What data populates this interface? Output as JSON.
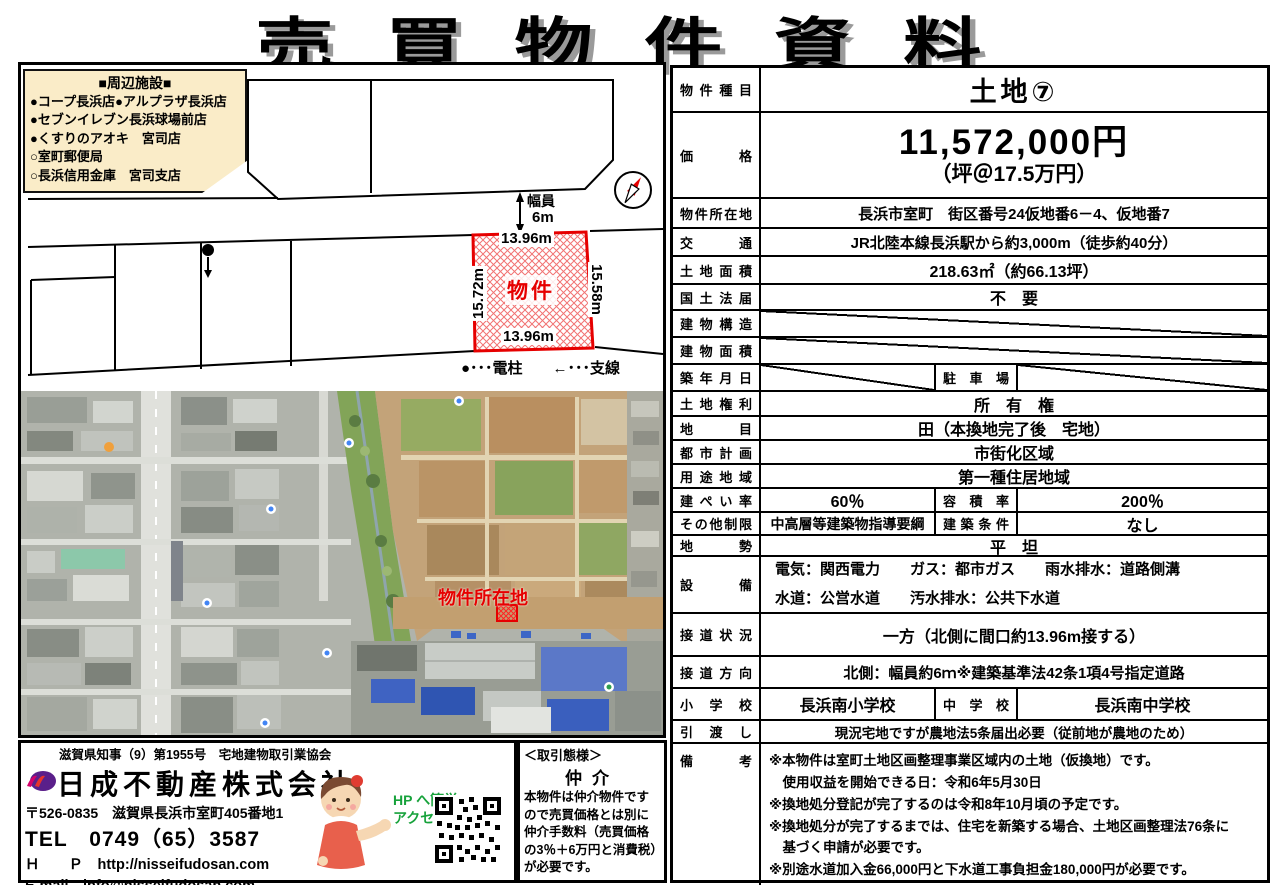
{
  "title": "売買物件資料",
  "diagram": {
    "facilities_title": "■周辺施設■",
    "facilities": [
      "●コープ長浜店●アルプラザ長浜店",
      "●セブンイレブン長浜球場前店",
      "●くすりのアオキ　宮司店",
      "○室町郵便局",
      "○長浜信用金庫　宮司支店"
    ],
    "road_width_label": "幅員",
    "road_width_value": "6m",
    "plot_label": "物件",
    "dim_top": "13.96m",
    "dim_bottom": "13.96m",
    "dim_left": "15.72m",
    "dim_right": "15.58m",
    "legend": "●･･･電柱　　←･･･支線"
  },
  "photo": {
    "marker_label": "物件所在地"
  },
  "table": {
    "type": {
      "label": "物件種目",
      "value": "土地⑦"
    },
    "price": {
      "label": "価格",
      "value": "11,572,000円",
      "per_tsubo": "（坪＠17.5万円）"
    },
    "location": {
      "label": "物件所在地",
      "value": "長浜市室町　街区番号24仮地番6－4、仮地番7"
    },
    "access": {
      "label": "交通",
      "value": "JR北陸本線長浜駅から約3,000m（徒歩約40分）"
    },
    "land_area": {
      "label": "土地面積",
      "value": "218.63㎡（約66.13坪）"
    },
    "national_land": {
      "label": "国土法届",
      "value": "不　要"
    },
    "building_structure": {
      "label": "建物構造"
    },
    "building_area": {
      "label": "建物面積"
    },
    "build_date": {
      "label": "築年月日",
      "sub_label": "駐車場"
    },
    "land_rights": {
      "label": "土地権利",
      "value": "所　有　権"
    },
    "land_category": {
      "label": "地目",
      "value": "田（本換地完了後　宅地）"
    },
    "city_planning": {
      "label": "都市計画",
      "value": "市街化区域"
    },
    "zoning": {
      "label": "用途地域",
      "value": "第一種住居地域"
    },
    "coverage": {
      "label": "建ぺい率",
      "value": "60％",
      "sub_label": "容積率",
      "sub_value": "200％"
    },
    "other_restrictions": {
      "label": "その他制限",
      "value": "中高層等建築物指導要綱",
      "sub_label": "建築条件",
      "sub_value": "なし"
    },
    "terrain": {
      "label": "地勢",
      "value": "平　坦"
    },
    "utilities": {
      "label": "設備",
      "line1": "電気：関西電力　　ガス：都市ガス　　雨水排水：道路側溝",
      "line2": "水道：公営水道　　汚水排水：公共下水道"
    },
    "road_contact": {
      "label": "接道状況",
      "value": "一方（北側に間口約13.96m接する）"
    },
    "road_direction": {
      "label": "接道方向",
      "value": "北側：幅員約6ｍ※建築基準法42条1項4号指定道路"
    },
    "schools": {
      "label": "小学校",
      "value": "長浜南小学校",
      "sub_label": "中学校",
      "sub_value": "長浜南中学校"
    },
    "handover": {
      "label": "引渡し",
      "value": "現況宅地ですが農地法5条届出必要（従前地が農地のため）"
    },
    "remarks": {
      "label": "備考",
      "lines": [
        "※本物件は室町土地区画整理事業区域内の土地（仮換地）です。",
        "　使用収益を開始できる日：令和6年5月30日",
        "※換地処分登記が完了するのは令和8年10月頃の予定です。",
        "※換地処分が完了するまでは、住宅を新築する場合、土地区画整理法76条に",
        "　基づく申請が必要です。",
        "※別途水道加入金66,000円と下水道工事負担金180,000円が必要です。"
      ]
    }
  },
  "footer": {
    "license": "滋賀県知事（9）第1955号　宅地建物取引業協会",
    "company": "日成不動産株式会社",
    "address": "〒526-0835　滋賀県長浜市室町405番地1",
    "tel": "TEL　0749（65）3587",
    "hp_line": "Ｈ　　Ｐ　http://nisseifudosan.com",
    "email_line": "E-mail　info@nisseifudosan.com",
    "hp_access_1": "HP へ簡単",
    "hp_access_2": "アクセス！"
  },
  "transaction": {
    "header": "＜取引態様＞",
    "type": "仲介",
    "body": "本物件は仲介物件ですので売買価格とは別に仲介手数料（売買価格の3％＋6万円と消費税）が必要です。"
  },
  "colors": {
    "accent_red": "#e60000",
    "cream": "#faecc8",
    "green_text": "#17a23b"
  }
}
